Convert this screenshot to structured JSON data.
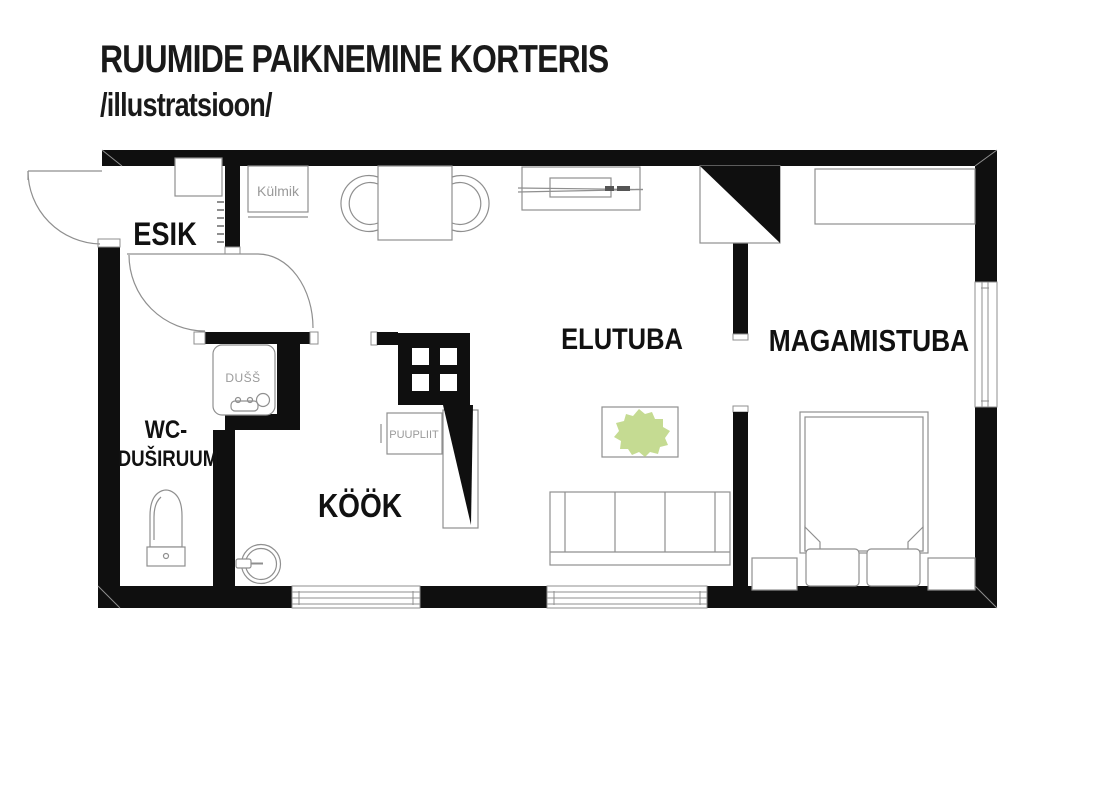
{
  "title": {
    "line1": "RUUMIDE PAIKNEMINE KORTERIS",
    "line2": "/illustratsioon/"
  },
  "rooms": {
    "esik": "ESIK",
    "wc_line1": "WC-",
    "wc_line2": "DUŠIRUUM",
    "kook": "KÖÖK",
    "elutuba": "ELUTUBA",
    "magamistuba": "MAGAMISTUBA"
  },
  "labels": {
    "fridge": "Külmik",
    "shower": "DUŠŠ",
    "stove": "PUUPLIIT"
  },
  "colors": {
    "wall": "#0f0f0f",
    "outline": "#8f8f8f",
    "text": "#1a1a1a",
    "muted_text": "#9a9a9a",
    "plant": "#c5db92",
    "background": "#ffffff"
  }
}
